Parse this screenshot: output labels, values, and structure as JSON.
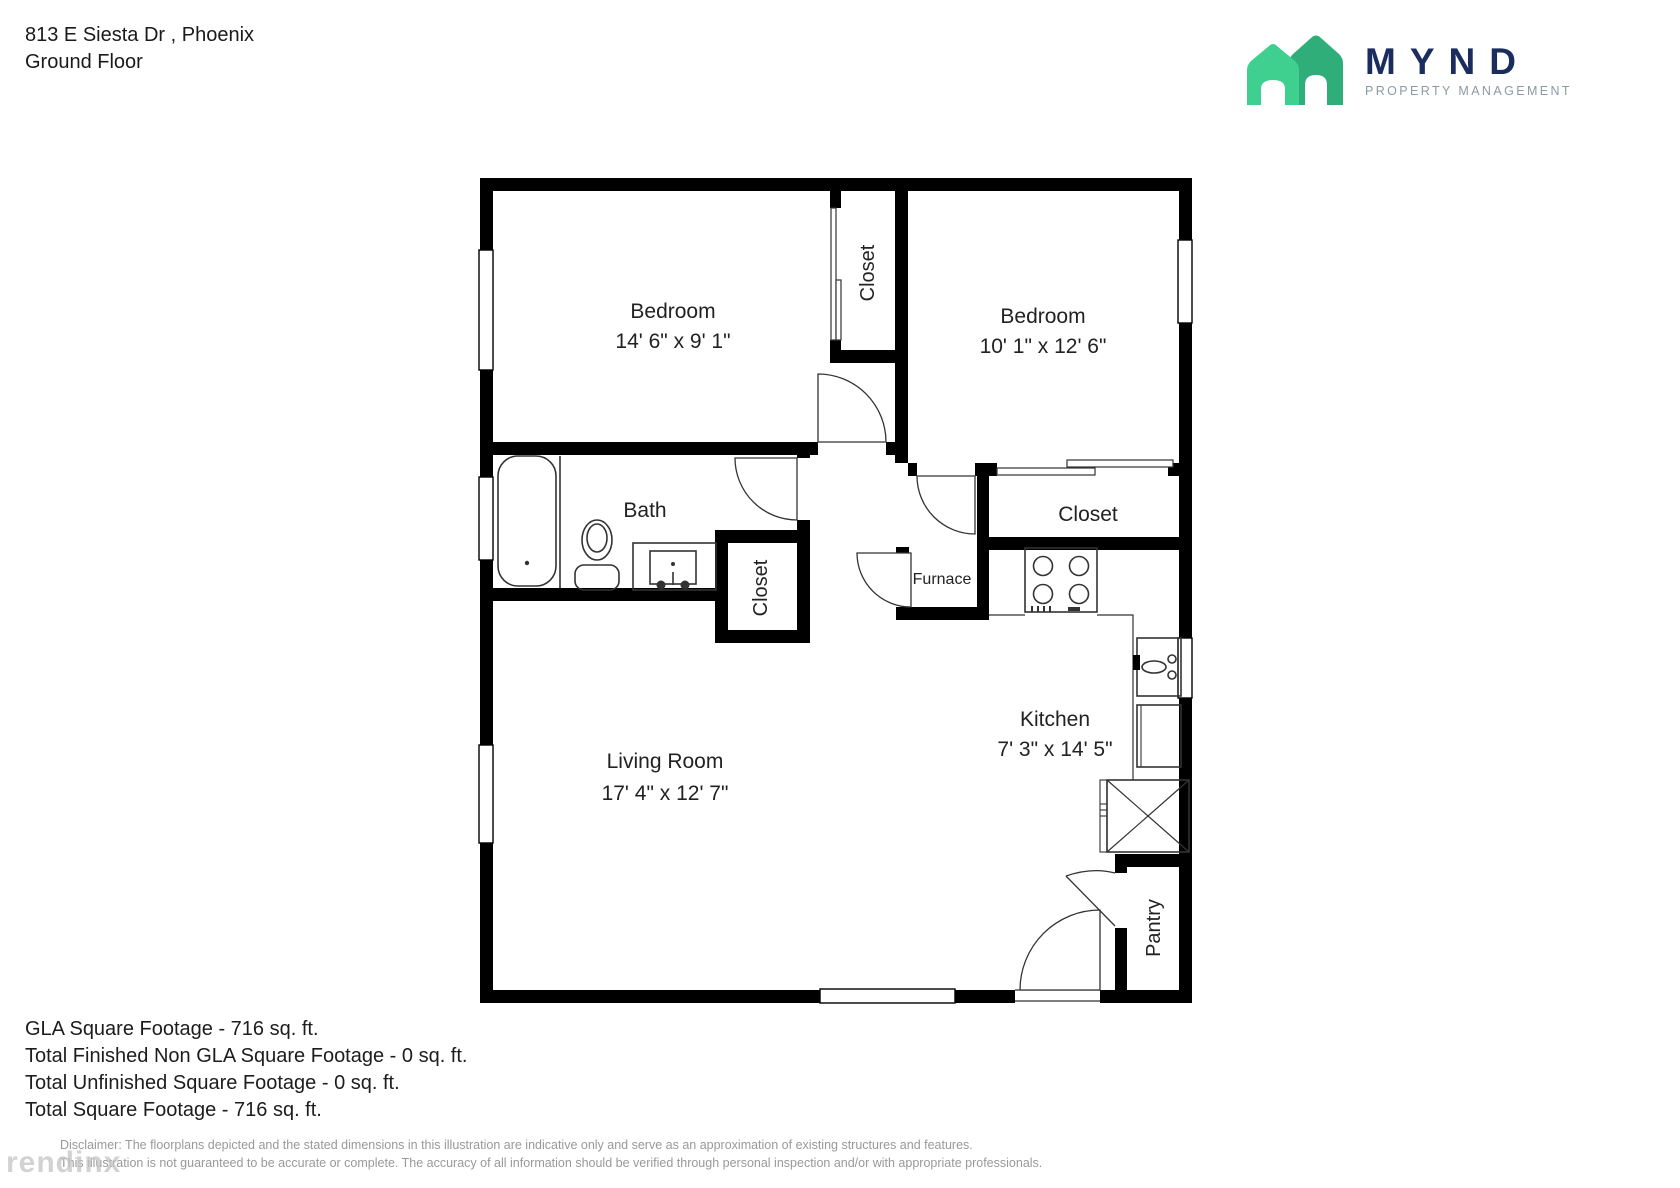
{
  "header": {
    "address": "813 E Siesta Dr , Phoenix",
    "floor": "Ground Floor"
  },
  "logo": {
    "brand": "MYND",
    "tagline": "PROPERTY MANAGEMENT",
    "house_front_color": "#3fd08f",
    "house_back_color": "#2fae79",
    "brand_color": "#1b2c5e",
    "tagline_color": "#8d99a4"
  },
  "plan": {
    "rooms": {
      "bedroom1": {
        "name": "Bedroom",
        "dims": "14' 6\" x 9' 1\""
      },
      "bedroom2": {
        "name": "Bedroom",
        "dims": "10' 1\" x 12' 6\""
      },
      "closet_bedrooms": {
        "name": "Closet"
      },
      "closet_hall": {
        "name": "Closet"
      },
      "closet_bedroom2": {
        "name": "Closet"
      },
      "bath": {
        "name": "Bath"
      },
      "furnace": {
        "name": "Furnace"
      },
      "kitchen": {
        "name": "Kitchen",
        "dims": "7' 3\" x 14' 5\""
      },
      "living": {
        "name": "Living Room",
        "dims": "17' 4\" x 12' 7\""
      },
      "pantry": {
        "name": "Pantry"
      }
    },
    "wall_color": "#000000"
  },
  "footer": {
    "line1": "GLA Square Footage - 716 sq. ft.",
    "line2": "Total Finished Non GLA Square Footage - 0 sq. ft.",
    "line3": "Total Unfinished Square Footage - 0 sq. ft.",
    "line4": "Total Square Footage - 716 sq. ft.",
    "disclaimer1": "Disclaimer: The floorplans depicted and the stated dimensions in this illustration are indicative only and serve as an approximation of existing structures and features.",
    "disclaimer2": "This illustration is not guaranteed to be accurate or complete. The accuracy of all information should be verified through personal inspection and/or with appropriate professionals.",
    "watermark": "rendinx"
  }
}
